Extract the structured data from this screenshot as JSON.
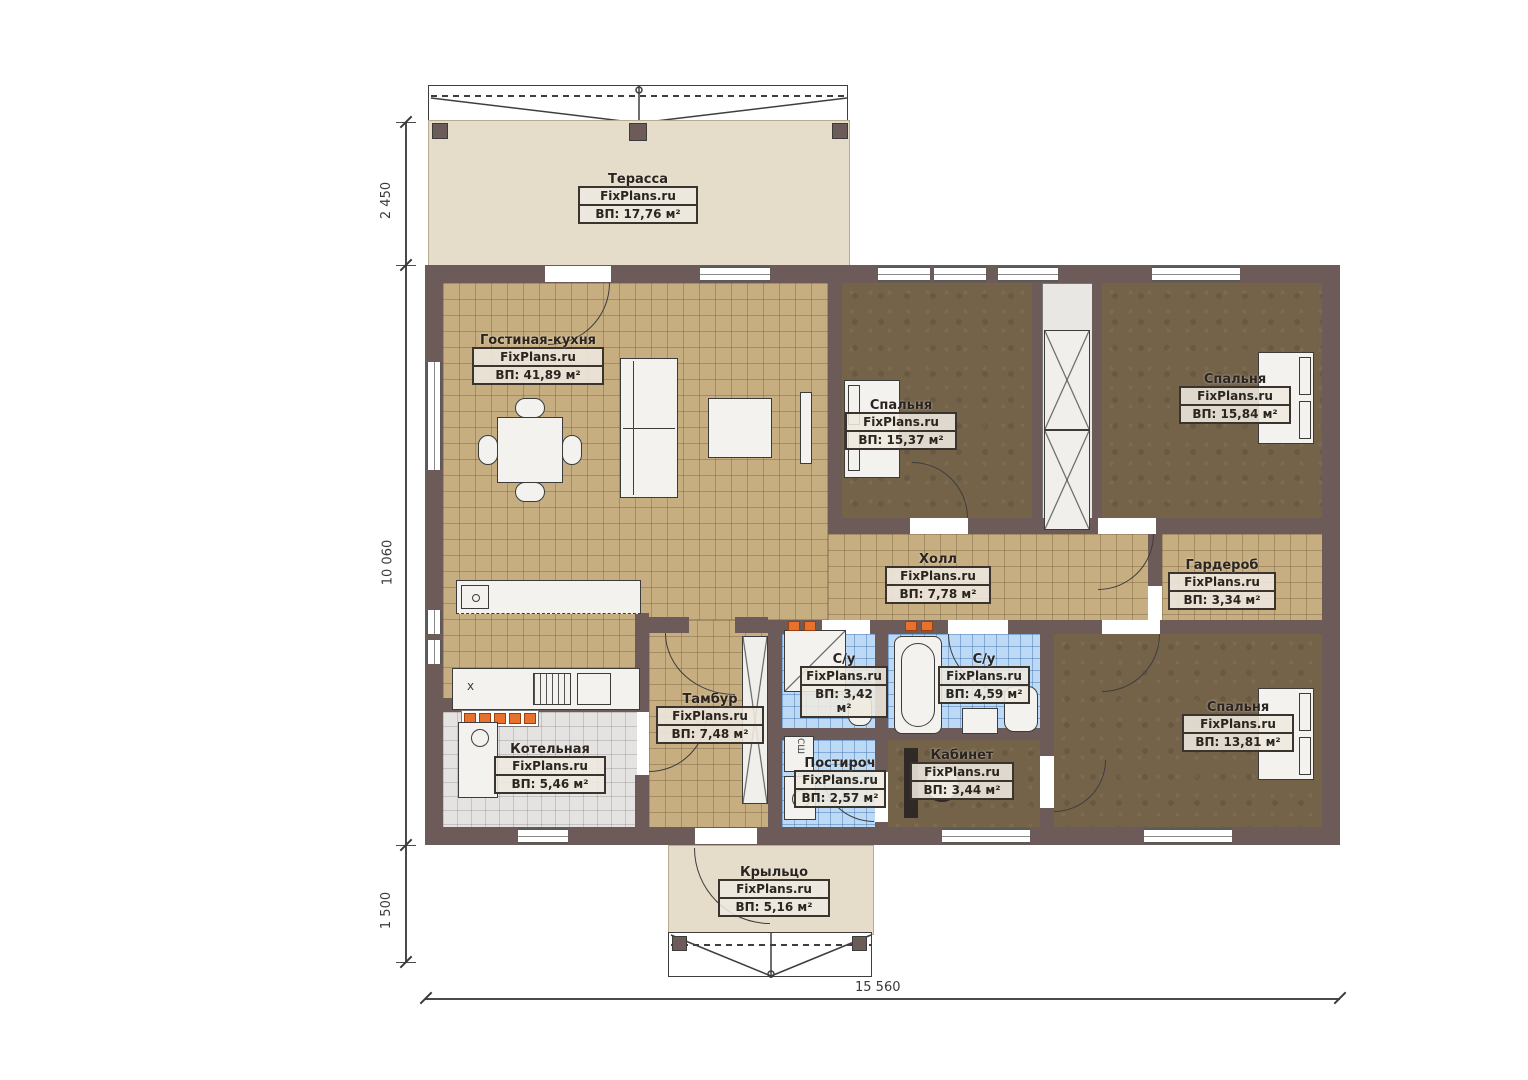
{
  "brand": "FixPlans.ru",
  "rooms": [
    {
      "name": "Терасса",
      "brand": "FixPlans.ru",
      "area": "ВП: 17,76 м²"
    },
    {
      "name": "Гостиная-кухня",
      "brand": "FixPlans.ru",
      "area": "ВП: 41,89 м²"
    },
    {
      "name": "Спальня",
      "brand": "FixPlans.ru",
      "area": "ВП: 15,37 м²"
    },
    {
      "name": "Спальня",
      "brand": "FixPlans.ru",
      "area": "ВП: 15,84 м²"
    },
    {
      "name": "Холл",
      "brand": "FixPlans.ru",
      "area": "ВП: 7,78 м²"
    },
    {
      "name": "Гардероб",
      "brand": "FixPlans.ru",
      "area": "ВП: 3,34 м²"
    },
    {
      "name": "Тамбур",
      "brand": "FixPlans.ru",
      "area": "ВП: 7,48 м²"
    },
    {
      "name": "С/у",
      "brand": "FixPlans.ru",
      "area": "ВП: 3,42 м²"
    },
    {
      "name": "С/у",
      "brand": "FixPlans.ru",
      "area": "ВП: 4,59 м²"
    },
    {
      "name": "Котельная",
      "brand": "FixPlans.ru",
      "area": "ВП: 5,46 м²"
    },
    {
      "name": "Постироч",
      "brand": "FixPlans.ru",
      "area": "ВП: 2,57 м²"
    },
    {
      "name": "Кабинет",
      "brand": "FixPlans.ru",
      "area": "ВП: 3,44 м²"
    },
    {
      "name": "Спальня",
      "brand": "FixPlans.ru",
      "area": "ВП: 13,81 м²"
    },
    {
      "name": "Крыльцо",
      "brand": "FixPlans.ru",
      "area": "ВП: 5,16 м²"
    }
  ],
  "dimensions": {
    "left_top": "2 450",
    "left_middle": "10 060",
    "left_bottom": "1 500",
    "bottom": "15 560"
  },
  "annotations": {
    "dryer_cabinet": "СШ",
    "counter_mark": "x"
  },
  "colors": {
    "wall": "#6c5b58",
    "tile_tan": "#c7ae80",
    "tile_blue": "#bcdaf5",
    "floor_brown": "#746349",
    "terrace_beige": "#e5dcca",
    "accent_orange": "#e8722c"
  }
}
